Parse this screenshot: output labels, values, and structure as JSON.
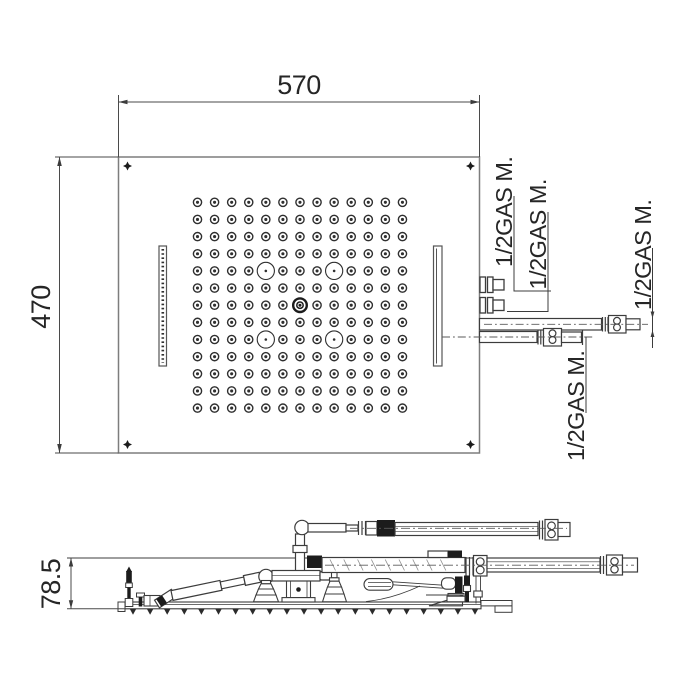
{
  "page": {
    "background": "#ffffff"
  },
  "dimensions": {
    "top_width": "570",
    "panel_height": "470",
    "side_profile_height": "78.5"
  },
  "connections": {
    "labels": [
      "1/2GAS M.",
      "1/2GAS M.",
      "1/2GAS M.",
      "1/2GAS M."
    ]
  },
  "nozzle_grid": {
    "rows": 13,
    "cols": 13,
    "large_nozzles": [
      [
        4,
        4
      ],
      [
        4,
        8
      ],
      [
        8,
        4
      ],
      [
        8,
        8
      ]
    ],
    "center_nozzle": [
      6,
      6
    ]
  },
  "colors": {
    "line": "#3c3c3c",
    "panel_line": "#7d7d7d",
    "dark": "#1c1c1c",
    "centerline": "#5a5a5a",
    "background": "#ffffff"
  }
}
